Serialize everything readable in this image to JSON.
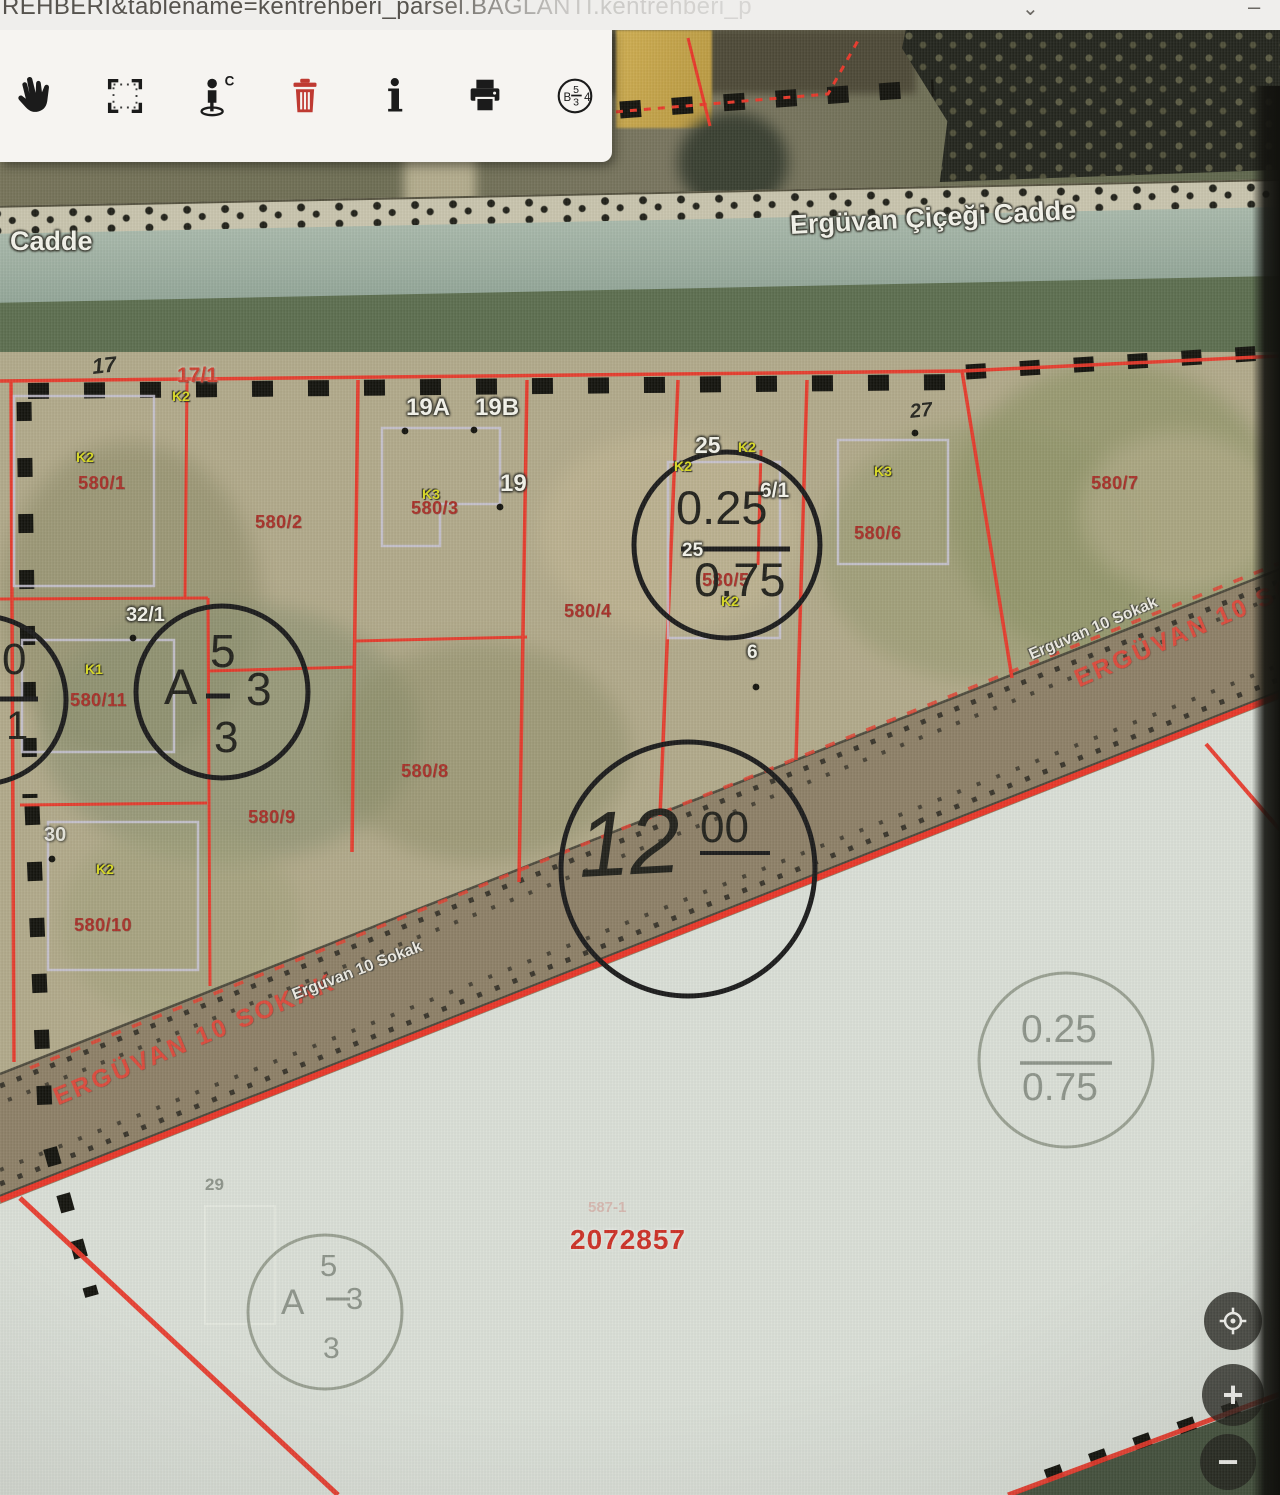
{
  "browser": {
    "url_fragment": "REHBERI&tablename=kentrehberi_parsel.BAGLANTI.kentrehberi_p",
    "chevron": "⌄",
    "window_dash": "–"
  },
  "toolbar": {
    "tools": [
      {
        "name": "pan-hand"
      },
      {
        "name": "select-area"
      },
      {
        "name": "street-view"
      },
      {
        "name": "delete"
      },
      {
        "name": "info"
      },
      {
        "name": "print"
      },
      {
        "name": "zoning-badge"
      }
    ],
    "zoning_badge": {
      "left": "B",
      "numerator": "5",
      "denominator": "3",
      "right": "4"
    }
  },
  "map": {
    "controls": {
      "zoom_in": "+",
      "zoom_out": "−"
    },
    "main_parcel_id": "2072857",
    "labels": [
      {
        "t": "Cadde",
        "x": 10,
        "y": 228,
        "c": "wl",
        "s": 27,
        "n": "street-label"
      },
      {
        "t": "Ergüvan Çiçeği Cadde",
        "x": 790,
        "y": 212,
        "c": "wl",
        "s": 27,
        "r": -3,
        "n": "street-label"
      },
      {
        "t": "17",
        "x": 92,
        "y": 356,
        "c": "bl",
        "s": 22,
        "r": -6,
        "n": "house-number-label"
      },
      {
        "t": "17/1",
        "x": 177,
        "y": 365,
        "c": "ro",
        "s": 21,
        "n": "house-number-label"
      },
      {
        "t": "K2",
        "x": 172,
        "y": 389,
        "c": "yl",
        "s": 14,
        "n": "zoning-code-label"
      },
      {
        "t": "K2",
        "x": 76,
        "y": 450,
        "c": "yl",
        "s": 14,
        "n": "zoning-code-label"
      },
      {
        "t": "580/1",
        "x": 78,
        "y": 474,
        "c": "rl",
        "s": 18,
        "n": "parcel-number-label"
      },
      {
        "t": "580/2",
        "x": 255,
        "y": 513,
        "c": "rl",
        "s": 18,
        "n": "parcel-number-label"
      },
      {
        "t": "19A",
        "x": 406,
        "y": 396,
        "c": "wl",
        "s": 24,
        "n": "house-number-label"
      },
      {
        "t": "19B",
        "x": 475,
        "y": 396,
        "c": "wl",
        "s": 24,
        "n": "house-number-label"
      },
      {
        "t": "19",
        "x": 500,
        "y": 472,
        "c": "wl",
        "s": 24,
        "n": "house-number-label"
      },
      {
        "t": "K3",
        "x": 422,
        "y": 487,
        "c": "yl",
        "s": 14,
        "n": "zoning-code-label"
      },
      {
        "t": "580/3",
        "x": 411,
        "y": 499,
        "c": "rl",
        "s": 18,
        "n": "parcel-number-label"
      },
      {
        "t": "580/4",
        "x": 564,
        "y": 602,
        "c": "rl",
        "s": 18,
        "n": "parcel-number-label"
      },
      {
        "t": "25",
        "x": 695,
        "y": 434,
        "c": "wl",
        "s": 23,
        "n": "house-number-label"
      },
      {
        "t": "K2",
        "x": 738,
        "y": 440,
        "c": "yl",
        "s": 14,
        "n": "zoning-code-label"
      },
      {
        "t": "K2",
        "x": 674,
        "y": 459,
        "c": "yl",
        "s": 14,
        "n": "zoning-code-label"
      },
      {
        "t": "6/1",
        "x": 760,
        "y": 480,
        "c": "wl",
        "s": 21,
        "n": "house-number-label"
      },
      {
        "t": "25",
        "x": 682,
        "y": 541,
        "c": "wl",
        "s": 19,
        "n": "house-number-label"
      },
      {
        "t": "580/5",
        "x": 702,
        "y": 571,
        "c": "rl",
        "s": 18,
        "n": "parcel-number-label"
      },
      {
        "t": "K2",
        "x": 721,
        "y": 594,
        "c": "yl",
        "s": 14,
        "n": "zoning-code-label"
      },
      {
        "t": "6",
        "x": 747,
        "y": 643,
        "c": "wl",
        "s": 19,
        "n": "house-number-label"
      },
      {
        "t": "K3",
        "x": 874,
        "y": 464,
        "c": "yl",
        "s": 14,
        "n": "zoning-code-label"
      },
      {
        "t": "580/6",
        "x": 854,
        "y": 524,
        "c": "rl",
        "s": 18,
        "n": "parcel-number-label"
      },
      {
        "t": "27",
        "x": 910,
        "y": 402,
        "c": "bl",
        "s": 20,
        "r": -6,
        "n": "house-number-label"
      },
      {
        "t": "580/7",
        "x": 1091,
        "y": 474,
        "c": "rl",
        "s": 18,
        "n": "parcel-number-label"
      },
      {
        "t": "32/1",
        "x": 126,
        "y": 605,
        "c": "wl",
        "s": 20,
        "n": "house-number-label"
      },
      {
        "t": "K1",
        "x": 85,
        "y": 662,
        "c": "yl",
        "s": 14,
        "n": "zoning-code-label"
      },
      {
        "t": "580/11",
        "x": 70,
        "y": 691,
        "c": "rl",
        "s": 18,
        "n": "parcel-number-label"
      },
      {
        "t": "580/9",
        "x": 248,
        "y": 808,
        "c": "rl",
        "s": 18,
        "n": "parcel-number-label"
      },
      {
        "t": "580/8",
        "x": 401,
        "y": 762,
        "c": "rl",
        "s": 18,
        "n": "parcel-number-label"
      },
      {
        "t": "30",
        "x": 44,
        "y": 825,
        "c": "wg",
        "s": 20,
        "n": "house-number-label"
      },
      {
        "t": "K2",
        "x": 96,
        "y": 862,
        "c": "yl",
        "s": 14,
        "n": "zoning-code-label"
      },
      {
        "t": "580/10",
        "x": 74,
        "y": 916,
        "c": "rl",
        "s": 18,
        "n": "parcel-number-label"
      },
      {
        "t": "ERGÜVAN 10 SOKAK",
        "x": 55,
        "y": 1086,
        "c": "rr",
        "s": 25,
        "r": -22.8,
        "n": "street-label"
      },
      {
        "t": "Erguvan 10 Sokak",
        "x": 293,
        "y": 988,
        "c": "wr",
        "s": 16,
        "r": -21,
        "n": "street-label"
      },
      {
        "t": "Erguvan 10 Sokak",
        "x": 1030,
        "y": 648,
        "c": "wr",
        "s": 16,
        "r": -23,
        "n": "street-label"
      },
      {
        "t": "ERGÜVAN 10 SOKAK",
        "x": 1076,
        "y": 668,
        "c": "rr",
        "s": 25,
        "r": -23.5,
        "n": "street-label"
      },
      {
        "t": "29",
        "x": 205,
        "y": 1176,
        "c": "gl",
        "s": 17,
        "n": "house-number-label"
      },
      {
        "t": "587-1",
        "x": 588,
        "y": 1200,
        "c": "fp",
        "s": 15,
        "n": "faint-parcel-label"
      },
      {
        "t": "2072857",
        "x": 570,
        "y": 1226,
        "c": "rb",
        "s": 28,
        "n": "parcel-id-label"
      },
      {
        "t": "0.25",
        "x": 676,
        "y": 484,
        "c": "cb",
        "s": 47,
        "n": "zoning-ratio-annotation"
      },
      {
        "t": "0.75",
        "x": 694,
        "y": 556,
        "c": "cb",
        "s": 47,
        "n": "zoning-ratio-annotation"
      },
      {
        "t": "A",
        "x": 164,
        "y": 662,
        "c": "cb",
        "s": 50,
        "n": "zoning-annotation"
      },
      {
        "t": "5",
        "x": 210,
        "y": 628,
        "c": "cb",
        "s": 46,
        "n": "zoning-annotation"
      },
      {
        "t": "3",
        "x": 246,
        "y": 666,
        "c": "cb",
        "s": 46,
        "n": "zoning-annotation"
      },
      {
        "t": "3",
        "x": 214,
        "y": 716,
        "c": "cb",
        "s": 44,
        "n": "zoning-annotation"
      },
      {
        "t": "12",
        "x": 578,
        "y": 800,
        "c": "cb",
        "s": 92,
        "r": -3,
        "i": 1,
        "n": "road-width-annotation"
      },
      {
        "t": "00",
        "x": 700,
        "y": 806,
        "c": "cb",
        "s": 44,
        "n": "road-width-annotation"
      },
      {
        "t": "0",
        "x": 2,
        "y": 638,
        "c": "cb",
        "s": 44,
        "n": "zoning-ratio-annotation"
      },
      {
        "t": "1",
        "x": 6,
        "y": 706,
        "c": "cb",
        "s": 40,
        "n": "zoning-ratio-annotation"
      },
      {
        "t": "A",
        "x": 281,
        "y": 1285,
        "c": "cg",
        "s": 35,
        "n": "zoning-annotation"
      },
      {
        "t": "5",
        "x": 320,
        "y": 1250,
        "c": "cg",
        "s": 31,
        "n": "zoning-annotation"
      },
      {
        "t": "3",
        "x": 346,
        "y": 1283,
        "c": "cg",
        "s": 31,
        "n": "zoning-annotation"
      },
      {
        "t": "3",
        "x": 323,
        "y": 1334,
        "c": "cg",
        "s": 30,
        "n": "zoning-annotation"
      },
      {
        "t": "0.25",
        "x": 1021,
        "y": 1010,
        "c": "cg",
        "s": 39,
        "n": "zoning-ratio-annotation"
      },
      {
        "t": "0.75",
        "x": 1022,
        "y": 1068,
        "c": "cg",
        "s": 39,
        "n": "zoning-ratio-annotation"
      }
    ]
  },
  "colors": {
    "parcel_line": "#e8392b",
    "label_red": "#a8322a",
    "label_yellow": "#d9da25",
    "road_red_text": "#e2473a",
    "annotation_black": "#23231d",
    "annotation_gray": "#8d948a"
  }
}
